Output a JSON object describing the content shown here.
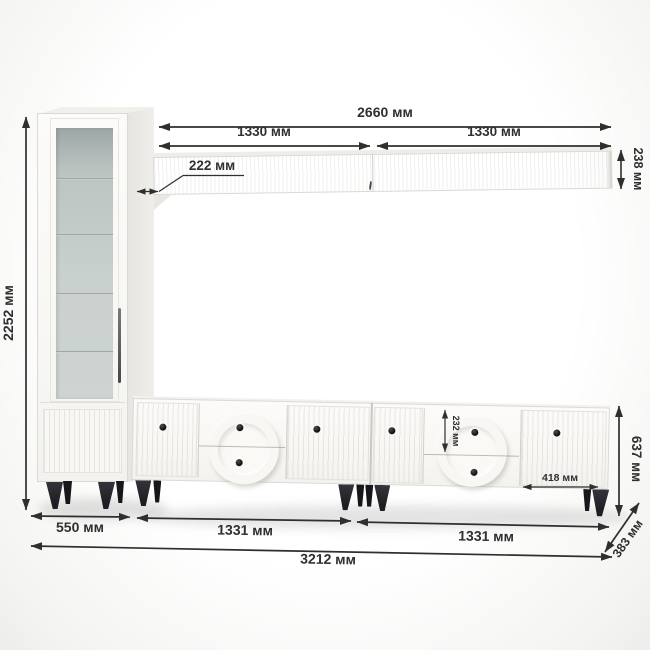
{
  "colors": {
    "furniture_body": "#faf9f6",
    "furniture_edge": "#dbd9d4",
    "glass": "#c3cac8",
    "legs": "#1d1d22",
    "dimension_ink": "#2f2f2f",
    "background": "#ffffff"
  },
  "dimensions": {
    "cabinet_height": "2252 мм",
    "shelf_total_width": "2660 мм",
    "shelf_section_left": "1330 мм",
    "shelf_section_right": "1330 мм",
    "shelf_height": "238 мм",
    "shelf_depth": "222 мм",
    "drawer_height": "232 мм",
    "door_width": "418 мм",
    "stand_height": "637 мм",
    "cabinet_width": "550 мм",
    "stand_section_left": "1331 мм",
    "stand_section_right": "1331 мм",
    "total_width": "3212 мм",
    "stand_depth": "383 мм"
  }
}
